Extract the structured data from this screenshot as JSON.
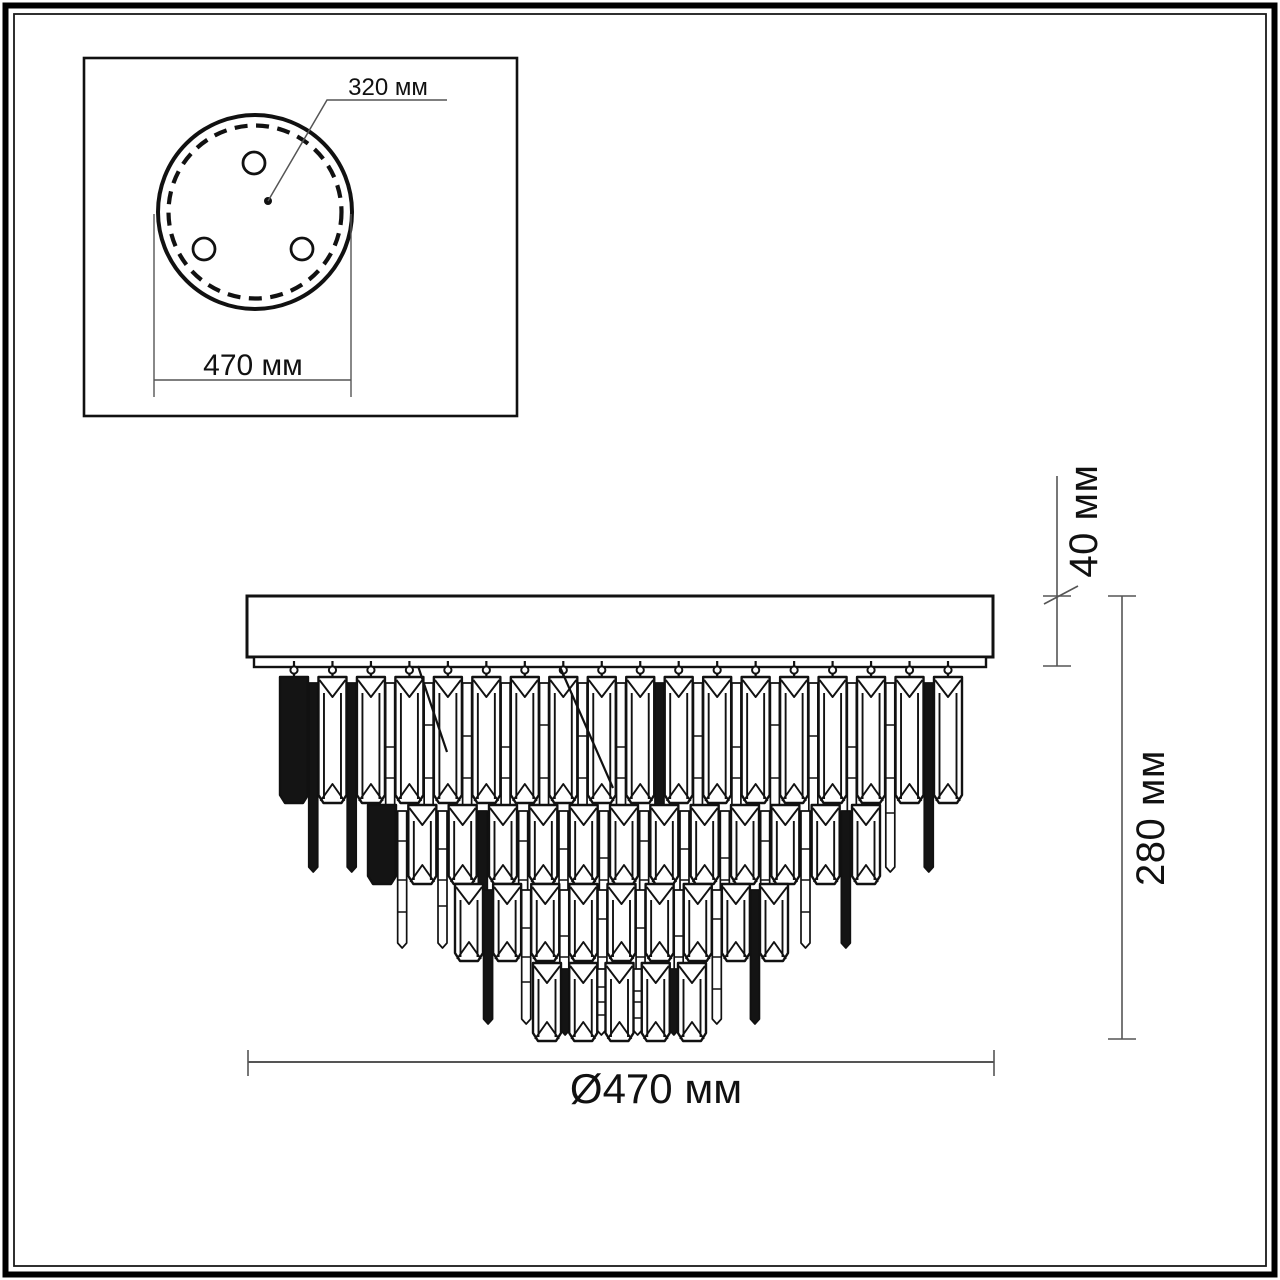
{
  "page": {
    "kind": "technical dimension drawing",
    "subject": "tiered crystal ceiling chandelier — front view and mounting plate view",
    "background": "#ffffff"
  },
  "colors": {
    "drawing_line": "#111111",
    "dimension_line": "#555555",
    "text": "#111111",
    "fill": "#ffffff",
    "dark_crystal": "#141414"
  },
  "inset": {
    "mount_point_spacing_label": "320 мм",
    "plate_diameter_label": "470 мм",
    "mount_holes_count": 3
  },
  "front_view": {
    "canopy_height_label": "40 мм",
    "total_height_label": "280 мм",
    "diameter_label": "Ø470 мм",
    "tiers_count": 4
  },
  "values": {
    "mount_point_spacing_mm": 320,
    "plate_diameter_mm": 470,
    "canopy_height_mm": 40,
    "total_height_mm": 280,
    "body_diameter_mm": 470,
    "unit": "мм"
  }
}
